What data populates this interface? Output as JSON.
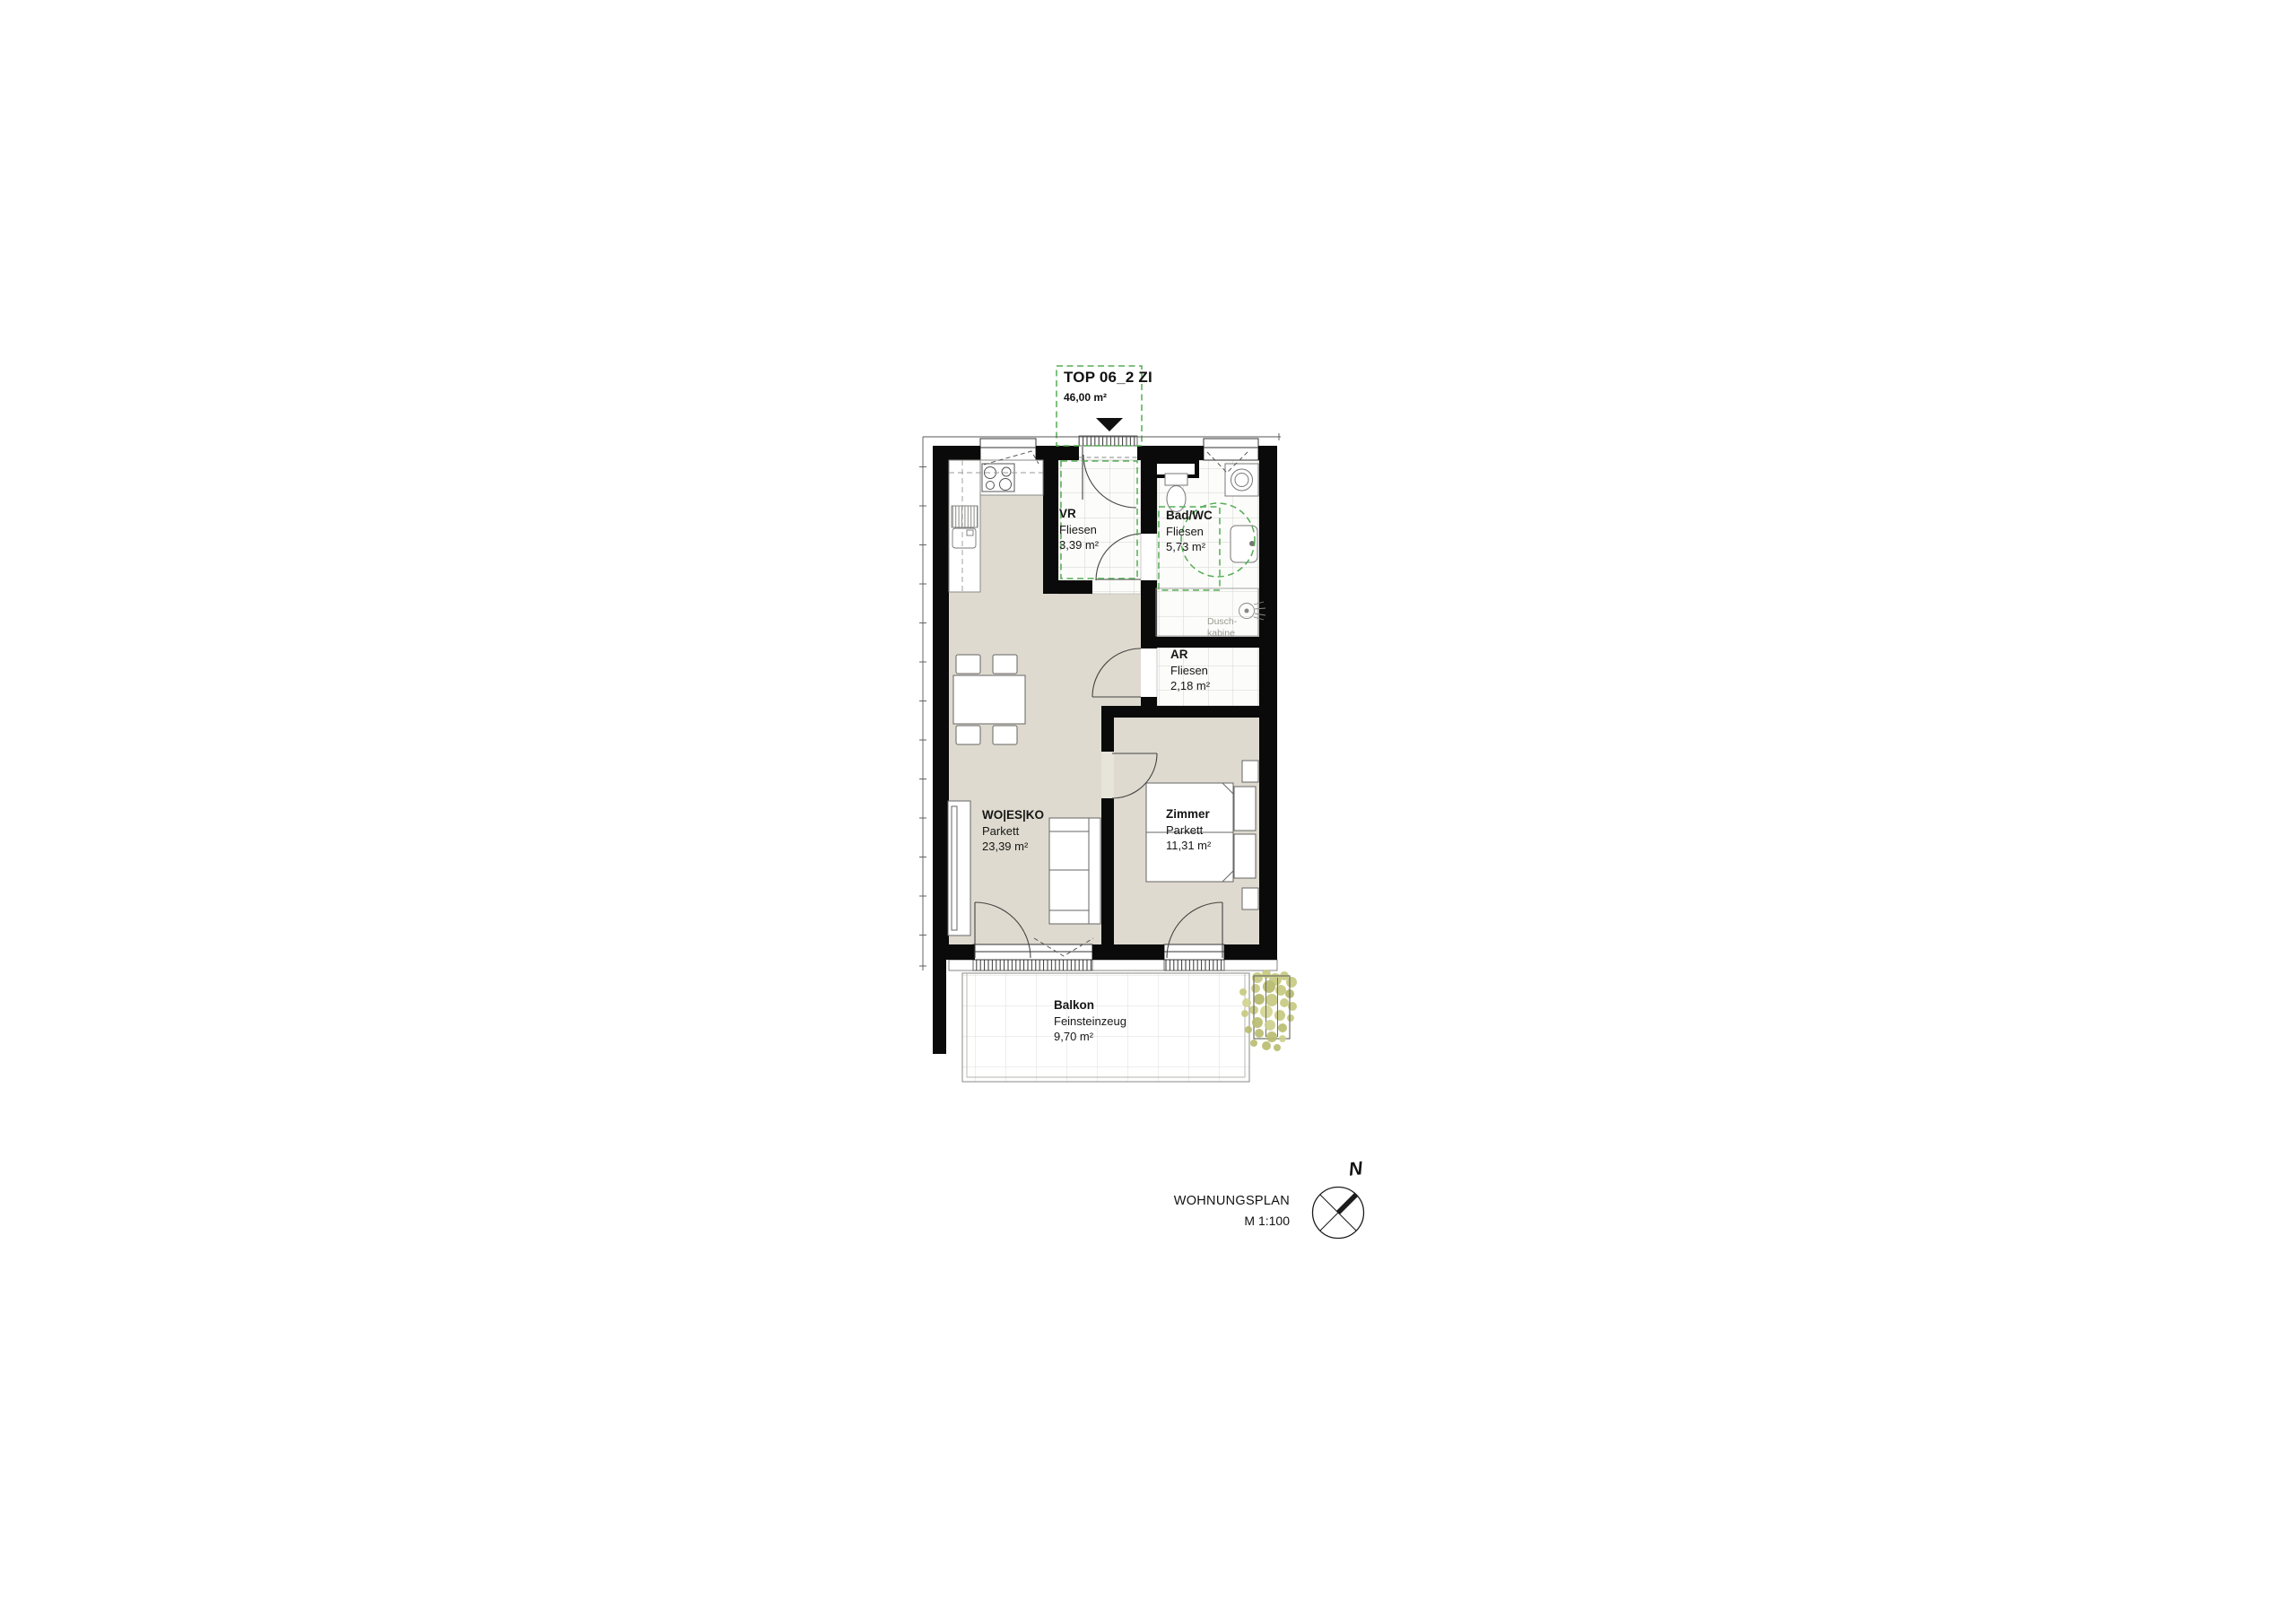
{
  "unit_label": {
    "name": "TOP 06_2 ZI",
    "area": "46,00 m²"
  },
  "rooms": {
    "vr": {
      "name": "VR",
      "floor": "Fliesen",
      "area": "3,39 m²"
    },
    "bad": {
      "name": "Bad/WC",
      "floor": "Fliesen",
      "area": "5,73 m²"
    },
    "ar": {
      "name": "AR",
      "floor": "Fliesen",
      "area": "2,18 m²"
    },
    "wohnen": {
      "name": "WO|ES|KO",
      "floor": "Parkett",
      "area": "23,39 m²"
    },
    "zimmer": {
      "name": "Zimmer",
      "floor": "Parkett",
      "area": "11,31 m²"
    },
    "balkon": {
      "name": "Balkon",
      "floor": "Feinsteinzeug",
      "area": "9,70 m²"
    }
  },
  "fixtures": {
    "shower_line1": "Dusch-",
    "shower_line2": "kabine"
  },
  "footer": {
    "plan_title": "WOHNUNGSPLAN",
    "scale": "M 1:100"
  },
  "compass": {
    "north_label": "N"
  },
  "colors": {
    "wall_black": "#0a0a0a",
    "floor_beige": "#dedacf",
    "accent_green": "#54ad54",
    "plant_olive": "#c0c378",
    "tile_grid": "#cbcbc6"
  }
}
